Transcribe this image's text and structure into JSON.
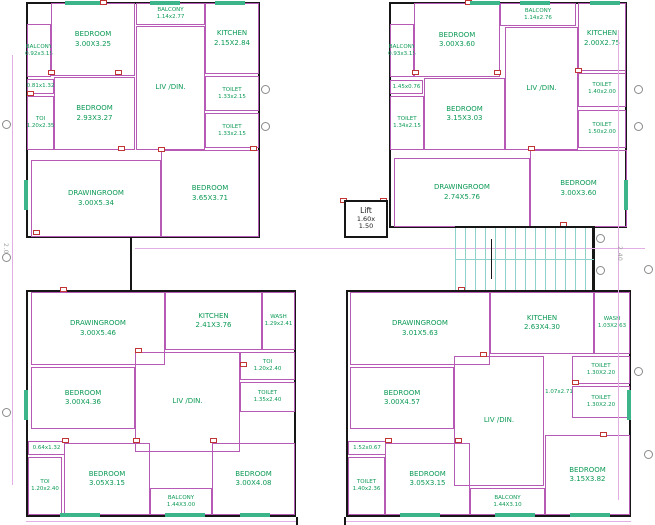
{
  "drawing": {
    "type": "architectural-floor-plan",
    "colors": {
      "wall": "#b65ab6",
      "outer_wall": "#161616",
      "room_text": "#0c9a55",
      "door": "#c03434",
      "stair_tread": "#8fd2cc",
      "dim_line": "#e3aee3",
      "window": "#3db58a"
    },
    "lift": {
      "label": "Lift",
      "dim_line1": "1.60x",
      "dim_line2": "1.50",
      "x": 344,
      "y": 200,
      "w": 44,
      "h": 38
    },
    "stairs": {
      "x": 455,
      "y": 226,
      "w": 139,
      "h": 66
    },
    "dim_texts": [
      {
        "text": "2.00",
        "x": 2,
        "y": 243
      },
      {
        "text": "2.40",
        "x": 616,
        "y": 246
      }
    ],
    "units": [
      {
        "name": "unit-top-left",
        "outline": {
          "x": 26,
          "y": 2,
          "w": 234,
          "h": 236
        },
        "rooms": [
          {
            "label": "BALCONY",
            "dims": "0.92x3.15",
            "x": 27,
            "y": 24,
            "w": 24,
            "h": 53,
            "small": true
          },
          {
            "label": "BEDROOM",
            "dims": "3.00X3.25",
            "x": 51,
            "y": 3,
            "w": 84,
            "h": 73
          },
          {
            "label": "BALCONY",
            "dims": "1.14x2.77",
            "x": 136,
            "y": 3,
            "w": 69,
            "h": 22,
            "small": true
          },
          {
            "label": "KITCHEN",
            "dims": "2.15X2.84",
            "x": 205,
            "y": 3,
            "w": 54,
            "h": 71
          },
          {
            "label": "",
            "dims": "0.81x1.32",
            "x": 27,
            "y": 79,
            "w": 27,
            "h": 15,
            "small": true
          },
          {
            "label": "TOI",
            "dims": "1.20x2.35",
            "x": 27,
            "y": 96,
            "w": 27,
            "h": 54,
            "small": true
          },
          {
            "label": "BEDROOM",
            "dims": "2.93X3.27",
            "x": 54,
            "y": 77,
            "w": 81,
            "h": 73
          },
          {
            "label": "LIV /DIN.",
            "dims": "",
            "x": 136,
            "y": 26,
            "w": 69,
            "h": 124
          },
          {
            "label": "TOILET",
            "dims": "1.33x2.15",
            "x": 205,
            "y": 76,
            "w": 54,
            "h": 35,
            "small": true
          },
          {
            "label": "TOILET",
            "dims": "1.33x2.15",
            "x": 205,
            "y": 113,
            "w": 54,
            "h": 35,
            "small": true
          },
          {
            "label": "DRAWINGROOM",
            "dims": "3.00X5.34",
            "x": 31,
            "y": 160,
            "w": 130,
            "h": 77
          },
          {
            "label": "BEDROOM",
            "dims": "3.65X3.71",
            "x": 161,
            "y": 150,
            "w": 98,
            "h": 87
          }
        ]
      },
      {
        "name": "unit-top-right",
        "outline": {
          "x": 389,
          "y": 2,
          "w": 238,
          "h": 226
        },
        "rooms": [
          {
            "label": "BALCONY",
            "dims": "0.93x3.15",
            "x": 390,
            "y": 24,
            "w": 24,
            "h": 53,
            "small": true
          },
          {
            "label": "BEDROOM",
            "dims": "3.00X3.60",
            "x": 414,
            "y": 3,
            "w": 86,
            "h": 74
          },
          {
            "label": "BALCONY",
            "dims": "1.14x2.76",
            "x": 500,
            "y": 3,
            "w": 76,
            "h": 23,
            "small": true
          },
          {
            "label": "KITCHEN",
            "dims": "2.00X2.75",
            "x": 578,
            "y": 3,
            "w": 48,
            "h": 71
          },
          {
            "label": "",
            "dims": "1.45x0.76",
            "x": 390,
            "y": 80,
            "w": 33,
            "h": 14,
            "small": true
          },
          {
            "label": "TOILET",
            "dims": "1.34x2.15",
            "x": 390,
            "y": 96,
            "w": 34,
            "h": 54,
            "small": true
          },
          {
            "label": "BEDROOM",
            "dims": "3.15X3.03",
            "x": 424,
            "y": 78,
            "w": 81,
            "h": 72
          },
          {
            "label": "LIV /DIN.",
            "dims": "",
            "x": 505,
            "y": 27,
            "w": 73,
            "h": 123
          },
          {
            "label": "TOILET",
            "dims": "1.40x2.00",
            "x": 578,
            "y": 70,
            "w": 48,
            "h": 37,
            "small": true
          },
          {
            "label": "TOILET",
            "dims": "1.50x2.00",
            "x": 578,
            "y": 110,
            "w": 48,
            "h": 38,
            "small": true
          },
          {
            "label": "DRAWINGROOM",
            "dims": "2.74X5.76",
            "x": 394,
            "y": 158,
            "w": 136,
            "h": 69
          },
          {
            "label": "BEDROOM",
            "dims": "3.00X3.60",
            "x": 530,
            "y": 150,
            "w": 97,
            "h": 77
          }
        ]
      },
      {
        "name": "unit-bottom-left",
        "outline": {
          "x": 26,
          "y": 290,
          "w": 270,
          "h": 227
        },
        "rooms": [
          {
            "label": "DRAWINGROOM",
            "dims": "3.00X5.46",
            "x": 31,
            "y": 292,
            "w": 134,
            "h": 73
          },
          {
            "label": "KITCHEN",
            "dims": "2.41X3.76",
            "x": 165,
            "y": 292,
            "w": 97,
            "h": 58
          },
          {
            "label": "WASH",
            "dims": "1.29x2.41",
            "x": 262,
            "y": 292,
            "w": 33,
            "h": 58,
            "small": true
          },
          {
            "label": "TOI",
            "dims": "1.20x2.40",
            "x": 240,
            "y": 352,
            "w": 55,
            "h": 28,
            "small": true
          },
          {
            "label": "TOILET",
            "dims": "1.35x2.40",
            "x": 240,
            "y": 382,
            "w": 55,
            "h": 30,
            "small": true
          },
          {
            "label": "BEDROOM",
            "dims": "3.00X4.36",
            "x": 31,
            "y": 367,
            "w": 104,
            "h": 62
          },
          {
            "label": "LIV /DIN.",
            "dims": "",
            "x": 135,
            "y": 352,
            "w": 105,
            "h": 100
          },
          {
            "label": "",
            "dims": "0.64x1.32",
            "x": 28,
            "y": 441,
            "w": 37,
            "h": 14,
            "small": true
          },
          {
            "label": "TOI",
            "dims": "1.20x2.40",
            "x": 28,
            "y": 457,
            "w": 34,
            "h": 58,
            "small": true
          },
          {
            "label": "BEDROOM",
            "dims": "3.05X3.15",
            "x": 64,
            "y": 443,
            "w": 86,
            "h": 72
          },
          {
            "label": "BALCONY",
            "dims": "1.44X3.00",
            "x": 150,
            "y": 488,
            "w": 62,
            "h": 27,
            "small": true
          },
          {
            "label": "BEDROOM",
            "dims": "3.00X4.08",
            "x": 212,
            "y": 443,
            "w": 83,
            "h": 72
          }
        ]
      },
      {
        "name": "unit-bottom-right",
        "outline": {
          "x": 346,
          "y": 290,
          "w": 285,
          "h": 227
        },
        "rooms": [
          {
            "label": "DRAWINGROOM",
            "dims": "3.01X5.63",
            "x": 350,
            "y": 292,
            "w": 140,
            "h": 73
          },
          {
            "label": "KITCHEN",
            "dims": "2.63X4.30",
            "x": 490,
            "y": 292,
            "w": 104,
            "h": 62
          },
          {
            "label": "WASH",
            "dims": "1.03X2.63",
            "x": 594,
            "y": 292,
            "w": 36,
            "h": 62,
            "small": true
          },
          {
            "label": "TOILET",
            "dims": "1.30X2.20",
            "x": 572,
            "y": 356,
            "w": 58,
            "h": 28,
            "small": true
          },
          {
            "label": "",
            "dims": "1.07x2.71",
            "x": 536,
            "y": 386,
            "w": 46,
            "h": 13,
            "small": true,
            "noborder": true
          },
          {
            "label": "TOILET",
            "dims": "1.30X2.20",
            "x": 572,
            "y": 386,
            "w": 58,
            "h": 32,
            "small": true
          },
          {
            "label": "BEDROOM",
            "dims": "3.00X4.57",
            "x": 350,
            "y": 367,
            "w": 104,
            "h": 62
          },
          {
            "label": "LIV /DIN.",
            "dims": "",
            "x": 454,
            "y": 356,
            "w": 90,
            "h": 130
          },
          {
            "label": "",
            "dims": "1.52x0.67",
            "x": 348,
            "y": 441,
            "w": 38,
            "h": 14,
            "small": true
          },
          {
            "label": "TOILET",
            "dims": "1.40x2.36",
            "x": 348,
            "y": 457,
            "w": 37,
            "h": 58,
            "small": true
          },
          {
            "label": "BEDROOM",
            "dims": "3.05X3.15",
            "x": 385,
            "y": 443,
            "w": 85,
            "h": 72
          },
          {
            "label": "BALCONY",
            "dims": "1.44X3.10",
            "x": 470,
            "y": 488,
            "w": 75,
            "h": 27,
            "small": true
          },
          {
            "label": "BEDROOM",
            "dims": "3.15X3.82",
            "x": 545,
            "y": 435,
            "w": 85,
            "h": 80
          }
        ]
      }
    ],
    "walls": [
      {
        "x": 130,
        "y": 238,
        "w": 2,
        "h": 52
      },
      {
        "x": 592,
        "y": 226,
        "w": 3,
        "h": 66
      },
      {
        "x": 296,
        "y": 517,
        "w": 2,
        "h": 8
      },
      {
        "x": 344,
        "y": 517,
        "w": 2,
        "h": 8
      }
    ],
    "dim_lines": [
      {
        "x": 135,
        "y": 248,
        "w": 510,
        "h": 1
      },
      {
        "x": 12,
        "y": 55,
        "w": 1,
        "h": 430
      },
      {
        "x": 618,
        "y": 30,
        "w": 1,
        "h": 470
      },
      {
        "x": 26,
        "y": 521,
        "w": 270,
        "h": 1
      },
      {
        "x": 346,
        "y": 521,
        "w": 285,
        "h": 1
      }
    ],
    "doors": [
      {
        "x": 100,
        "y": 0
      },
      {
        "x": 48,
        "y": 70
      },
      {
        "x": 115,
        "y": 70
      },
      {
        "x": 27,
        "y": 91
      },
      {
        "x": 118,
        "y": 146
      },
      {
        "x": 158,
        "y": 147
      },
      {
        "x": 33,
        "y": 230
      },
      {
        "x": 250,
        "y": 146
      },
      {
        "x": 465,
        "y": 0
      },
      {
        "x": 412,
        "y": 70
      },
      {
        "x": 494,
        "y": 70
      },
      {
        "x": 575,
        "y": 68
      },
      {
        "x": 528,
        "y": 146
      },
      {
        "x": 560,
        "y": 222
      },
      {
        "x": 340,
        "y": 198
      },
      {
        "x": 380,
        "y": 198
      },
      {
        "x": 60,
        "y": 287
      },
      {
        "x": 135,
        "y": 348
      },
      {
        "x": 240,
        "y": 362
      },
      {
        "x": 62,
        "y": 438
      },
      {
        "x": 133,
        "y": 438
      },
      {
        "x": 210,
        "y": 438
      },
      {
        "x": 458,
        "y": 287
      },
      {
        "x": 480,
        "y": 352
      },
      {
        "x": 572,
        "y": 380
      },
      {
        "x": 385,
        "y": 438
      },
      {
        "x": 455,
        "y": 438
      },
      {
        "x": 600,
        "y": 432
      }
    ],
    "windows": [
      {
        "x": 65,
        "y": 1,
        "w": 35,
        "h": 4
      },
      {
        "x": 150,
        "y": 1,
        "w": 30,
        "h": 4
      },
      {
        "x": 215,
        "y": 1,
        "w": 30,
        "h": 4
      },
      {
        "x": 470,
        "y": 1,
        "w": 30,
        "h": 4
      },
      {
        "x": 520,
        "y": 1,
        "w": 30,
        "h": 4
      },
      {
        "x": 590,
        "y": 1,
        "w": 30,
        "h": 4
      },
      {
        "x": 60,
        "y": 513,
        "w": 40,
        "h": 4
      },
      {
        "x": 165,
        "y": 513,
        "w": 40,
        "h": 4
      },
      {
        "x": 240,
        "y": 513,
        "w": 30,
        "h": 4
      },
      {
        "x": 400,
        "y": 513,
        "w": 40,
        "h": 4
      },
      {
        "x": 495,
        "y": 513,
        "w": 40,
        "h": 4
      },
      {
        "x": 570,
        "y": 513,
        "w": 40,
        "h": 4
      },
      {
        "x": 24,
        "y": 180,
        "w": 4,
        "h": 30
      },
      {
        "x": 624,
        "y": 180,
        "w": 4,
        "h": 30
      },
      {
        "x": 24,
        "y": 390,
        "w": 4,
        "h": 30
      },
      {
        "x": 627,
        "y": 390,
        "w": 4,
        "h": 30
      }
    ],
    "bubbles": [
      {
        "x": 2,
        "y": 120
      },
      {
        "x": 2,
        "y": 253
      },
      {
        "x": 2,
        "y": 408
      },
      {
        "x": 261,
        "y": 85
      },
      {
        "x": 261,
        "y": 122
      },
      {
        "x": 634,
        "y": 85
      },
      {
        "x": 634,
        "y": 122
      },
      {
        "x": 644,
        "y": 265
      },
      {
        "x": 634,
        "y": 367
      },
      {
        "x": 596,
        "y": 234
      },
      {
        "x": 596,
        "y": 266
      },
      {
        "x": 644,
        "y": 450
      }
    ]
  }
}
